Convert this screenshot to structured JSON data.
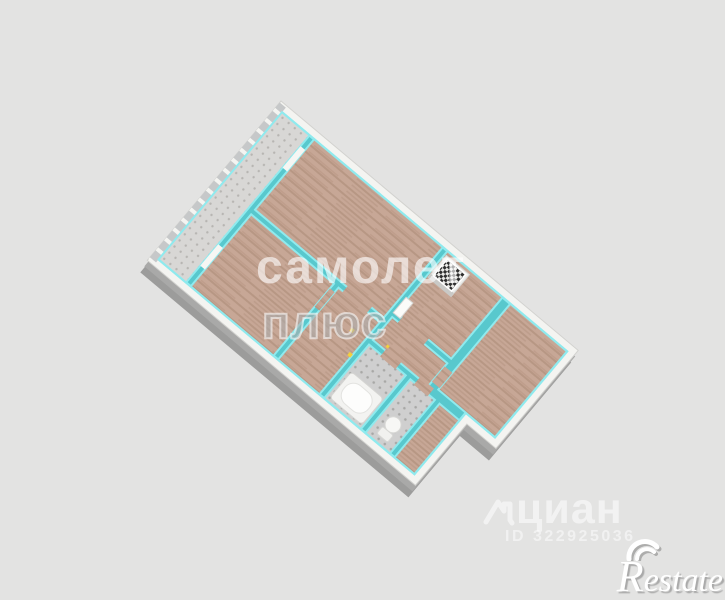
{
  "watermarks": {
    "samolet_line1": "самолет",
    "samolet_line2": "плюс",
    "cian_label": "циан",
    "cian_id": "ID 322925036",
    "restate_r": "R",
    "restate_rest": "estate"
  },
  "colors": {
    "background": "#e3e3e2",
    "wall_top_teal": "#58c8cd",
    "wall_face_cyan": "#8feaee",
    "wall_exterior_white": "#f4f4f1",
    "wood_floor": "#c7a796",
    "balcony_tile": "#d8d7d5",
    "bath_tile": "#cfcfcf",
    "window_glass": "#c6c8c9",
    "ground_shadow": "#9c9c9b",
    "marker_yellow": "#f2cf3e",
    "stove_top": "#2e2e2e"
  }
}
